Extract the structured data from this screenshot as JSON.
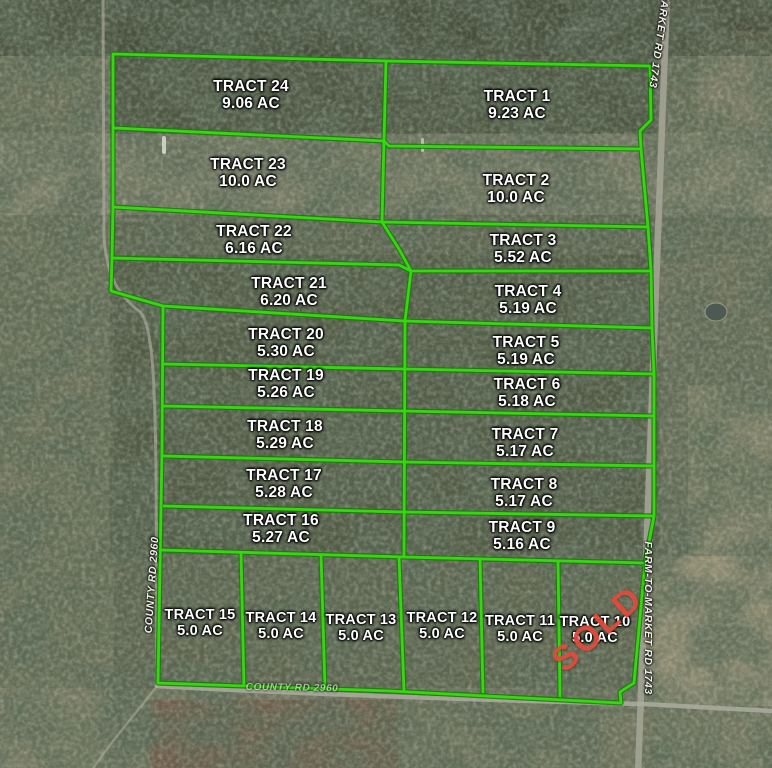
{
  "map": {
    "description": "Aerial plat map of 24 subdivided land tracts",
    "tracts": [
      {
        "name": "TRACT 1",
        "acreage": "9.23 AC"
      },
      {
        "name": "TRACT 2",
        "acreage": "10.0 AC"
      },
      {
        "name": "TRACT 3",
        "acreage": "5.52 AC"
      },
      {
        "name": "TRACT 4",
        "acreage": "5.19 AC"
      },
      {
        "name": "TRACT 5",
        "acreage": "5.19 AC"
      },
      {
        "name": "TRACT 6",
        "acreage": "5.18 AC"
      },
      {
        "name": "TRACT 7",
        "acreage": "5.17 AC"
      },
      {
        "name": "TRACT 8",
        "acreage": "5.17 AC"
      },
      {
        "name": "TRACT 9",
        "acreage": "5.16 AC"
      },
      {
        "name": "TRACT 10",
        "acreage": "5.0 AC",
        "status": "SOLD"
      },
      {
        "name": "TRACT 11",
        "acreage": "5.0 AC"
      },
      {
        "name": "TRACT 12",
        "acreage": "5.0 AC"
      },
      {
        "name": "TRACT 13",
        "acreage": "5.0 AC"
      },
      {
        "name": "TRACT 14",
        "acreage": "5.0 AC"
      },
      {
        "name": "TRACT 15",
        "acreage": "5.0 AC"
      },
      {
        "name": "TRACT 16",
        "acreage": "5.27 AC"
      },
      {
        "name": "TRACT 17",
        "acreage": "5.28 AC"
      },
      {
        "name": "TRACT 18",
        "acreage": "5.29 AC"
      },
      {
        "name": "TRACT 19",
        "acreage": "5.26 AC"
      },
      {
        "name": "TRACT 20",
        "acreage": "5.30 AC"
      },
      {
        "name": "TRACT 21",
        "acreage": "6.20 AC"
      },
      {
        "name": "TRACT 22",
        "acreage": "6.16 AC"
      },
      {
        "name": "TRACT 23",
        "acreage": "10.0 AC"
      },
      {
        "name": "TRACT 24",
        "acreage": "9.06 AC"
      }
    ],
    "roads": {
      "left": "COUNTY RD 2960",
      "bottom": "COUNTY RD 2960",
      "right": "FARM-TO-MARKET RD 1743",
      "right_top": "FARM-TO-MARKET RD 1743"
    },
    "colors": {
      "boundary_green": "#3bd414",
      "sold_red": "#e14b3c"
    }
  }
}
